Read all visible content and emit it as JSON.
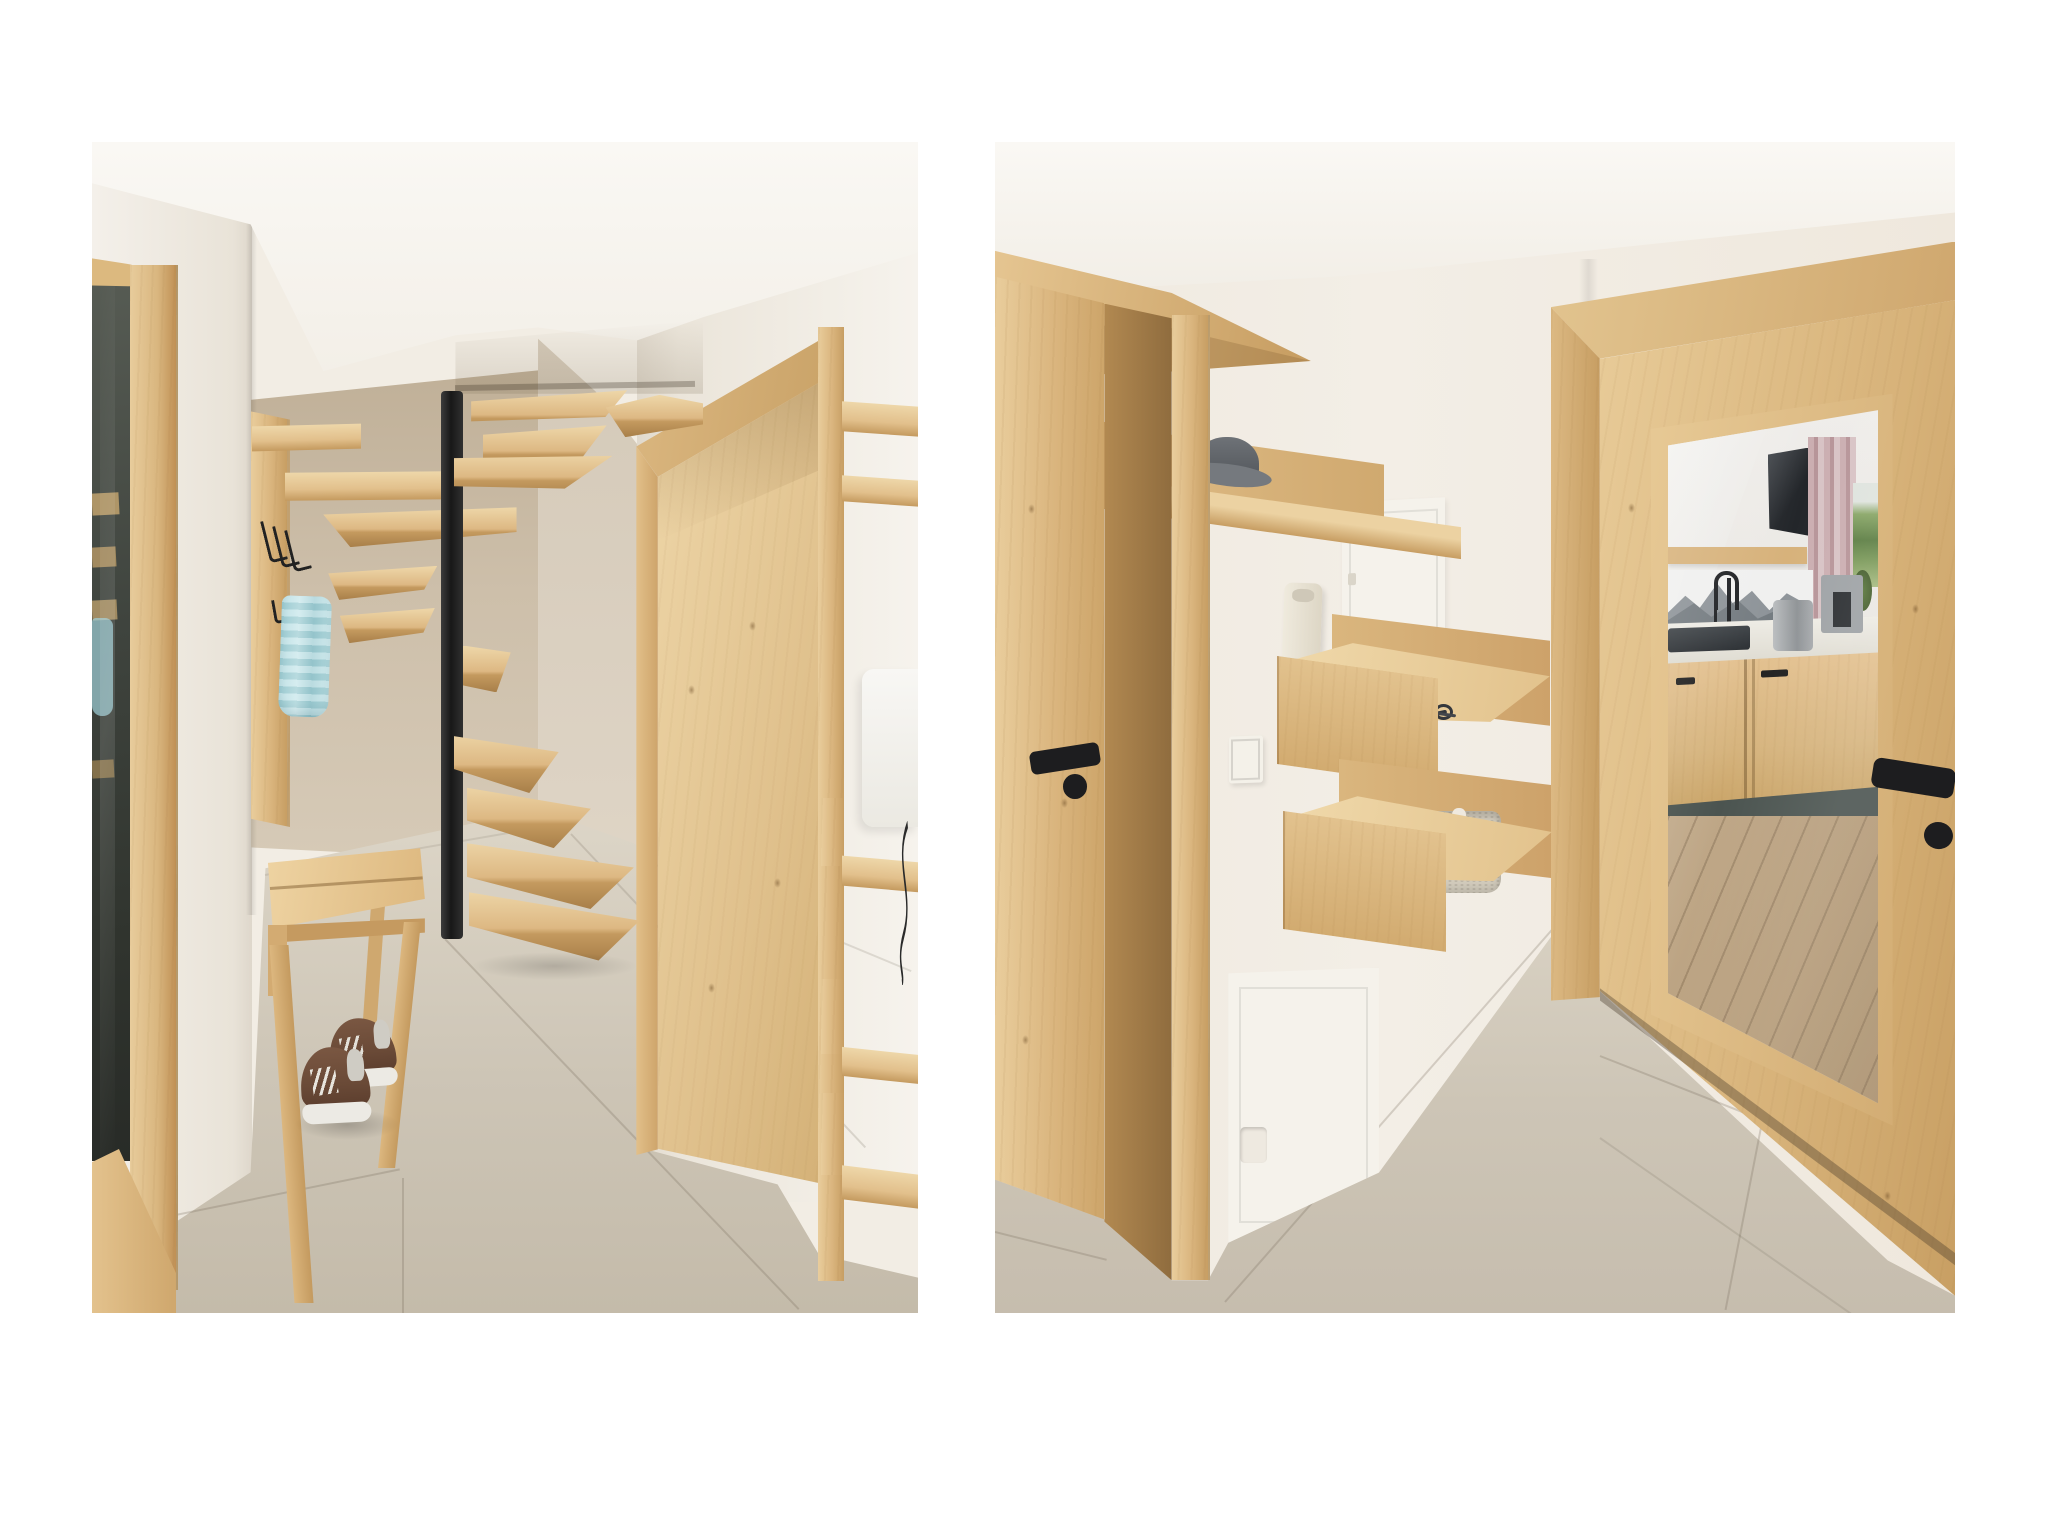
{
  "meta": {
    "description": "Montage of two photorealistic 3D interior renderings of an alpine-style apartment entry, placed side by side on a white page. No text appears in the image.",
    "image_type": "interior-render-montage"
  },
  "palette": {
    "page_bg": "#ffffff",
    "ceiling": "#f8f6f1",
    "wall_white": "#f2ede4",
    "wall_shade": "#e3dccf",
    "wall_beige": "#c8b9a4",
    "wall_beige_lt": "#d9cfc0",
    "wood_hi": "#eed7a9",
    "wood_mid": "#dcb781",
    "wood_lo": "#c49a5f",
    "wood_edge": "#a87f49",
    "floor_lt": "#ded7c9",
    "floor_md": "#cdc5b6",
    "floor_dk": "#c3baa9",
    "grout": "rgba(110,100,85,0.25)",
    "metal_black": "#1d1d1f",
    "glass_dark": "#3a3f3a",
    "towel_blue": "#aed9df",
    "hat_gray": "#63676c",
    "basket_beige": "#d2cbbc",
    "panel_white": "#f5f2eb",
    "intercom_cream": "#e9e3d3",
    "shoe_brown": "#6a4a37",
    "sole_white": "#eceae4",
    "mirror_tv": "#33373c",
    "mirror_curtain": "#c4a8ab",
    "mirror_hills": "#5e7f45",
    "mirror_counter": "#eceae3",
    "mirror_plinth": "#4b5450",
    "mirror_plank": "#b49a77"
  },
  "panels": [
    {
      "name": "hallway-with-spiral-staircase",
      "objects": [
        "glass-door",
        "door-frame",
        "coat-rack-panel",
        "wall-shelf",
        "wire-hooks",
        "hand-towel",
        "spiral-staircase",
        "steel-center-pole",
        "wood-treads",
        "wood-bench",
        "brown-sneakers",
        "tile-floor",
        "wardrobe-niche",
        "edge-shelf-unit",
        "radiator",
        "cable"
      ]
    },
    {
      "name": "entryway-with-mirror-door",
      "objects": [
        "open-wood-door",
        "black-door-handle",
        "door-frame",
        "hat-shelf",
        "felt-hat",
        "electrical-panel",
        "intercom-handset",
        "intercom-cord",
        "light-switch",
        "key-shelf",
        "smartphone",
        "key-bunch",
        "basket-shelf",
        "woven-basket",
        "service-panel",
        "mirror-door",
        "mirror-frame",
        "mirror-reflection-kitchen",
        "tile-floor"
      ]
    }
  ],
  "mirror_reflection": {
    "contents": [
      "sloped-white-ceiling",
      "wall-tv",
      "wood-wall-shelf",
      "dusty-pink-curtain",
      "window-with-green-hills",
      "mountain-photo-backsplash",
      "black-faucet",
      "dark-sink",
      "metal-toaster",
      "coffee-machine",
      "white-countertop",
      "oak-base-cabinets",
      "dark-plinth",
      "oak-plank-floor"
    ]
  }
}
